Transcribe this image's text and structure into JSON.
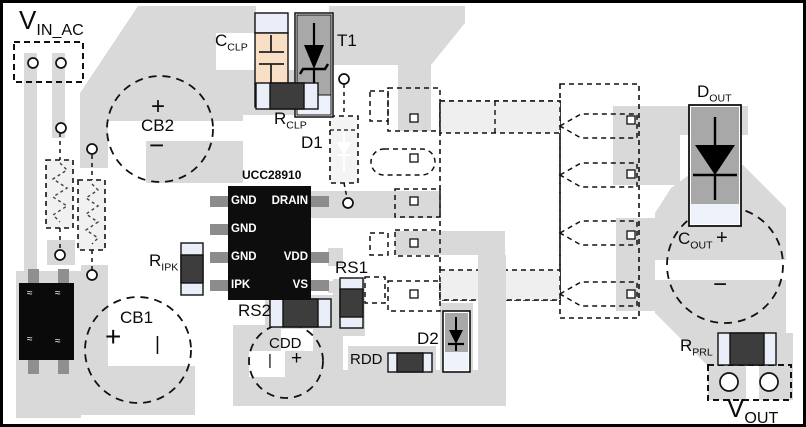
{
  "labels": {
    "vin": {
      "main": "V",
      "sub": "IN_AC"
    },
    "vout": {
      "main": "V",
      "sub": "OUT"
    },
    "cclp": {
      "main": "C",
      "sub": "CLP"
    },
    "rclp": {
      "main": "R",
      "sub": "CLP"
    },
    "ripk": {
      "main": "R",
      "sub": "IPK"
    },
    "rprl": {
      "main": "R",
      "sub": "PRL"
    },
    "dout": {
      "main": "D",
      "sub": "OUT"
    },
    "cout": {
      "main": "C",
      "sub": "OUT"
    },
    "t1": "T1",
    "d1": "D1",
    "d2": "D2",
    "rs1": "RS1",
    "rs2": "RS2",
    "cdd": "CDD",
    "rdd": "RDD",
    "cb1": "CB1",
    "cb2": "CB2"
  },
  "ic": {
    "part": "UCC28910",
    "pins_left": [
      "GND",
      "GND",
      "GND",
      "IPK"
    ],
    "pins_right": [
      "DRAIN",
      "VDD",
      "VS"
    ]
  },
  "polarity": {
    "cb2_plus": "+",
    "cb2_minus": "−",
    "cb1_plus": "+",
    "cb1_minus": "|",
    "cdd_minus": "|",
    "cdd_plus": "+",
    "cout_plus": "+",
    "cout_minus": "−"
  },
  "bridge": {
    "mark": "≈"
  },
  "colors": {
    "pour": "#D9D9D9",
    "winding_fill": "#EFEFEF",
    "ic_body": "#0D0D0D",
    "resistor_body": "#3D3D3D",
    "cap_end": "#E9EEF8",
    "diode_body": "#A8A8A8",
    "cclp_body": "#F9DFC5",
    "pin_stub": "#8C8C8C"
  }
}
